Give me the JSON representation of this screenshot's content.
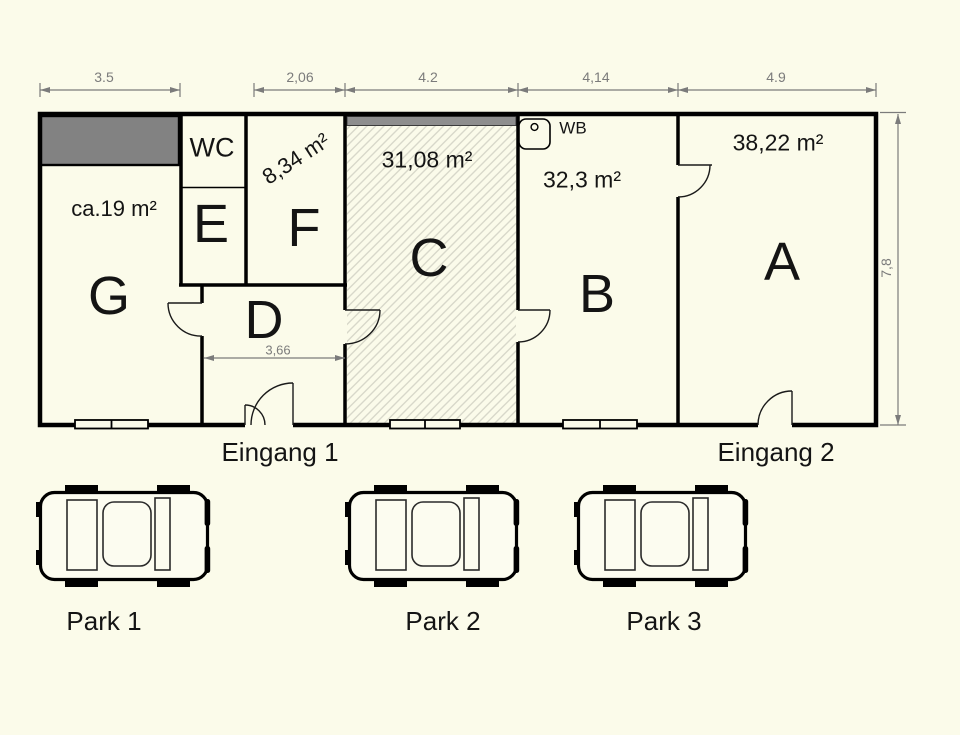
{
  "plan": {
    "dimensions": {
      "top": [
        "3.5",
        "2,06",
        "4.2",
        "4,14",
        "4.9"
      ],
      "right": "7,8",
      "room_d_width": "3,66"
    },
    "rooms": {
      "g": {
        "label": "G",
        "area": "ca.19 m²"
      },
      "wc": {
        "label": "WC"
      },
      "e": {
        "label": "E"
      },
      "f": {
        "label": "F",
        "area": "8,34 m²"
      },
      "d": {
        "label": "D"
      },
      "c": {
        "label": "C",
        "area": "31,08 m²"
      },
      "b": {
        "label": "B",
        "area": "32,3 m²"
      },
      "a": {
        "label": "A",
        "area": "38,22 m²"
      }
    },
    "fixtures": {
      "washbasin": "WB"
    },
    "entrances": {
      "entrance1": "Eingang 1",
      "entrance2": "Eingang 2"
    }
  },
  "parking": {
    "spots": [
      {
        "label": "Park 1"
      },
      {
        "label": "Park 2"
      },
      {
        "label": "Park 3"
      }
    ]
  },
  "colors": {
    "background": "#fbfbea",
    "wall": "#000000",
    "gray_fill": "#828282",
    "dimension_gray": "#7b7b7b",
    "hatch_line": "#d8d8ca"
  }
}
